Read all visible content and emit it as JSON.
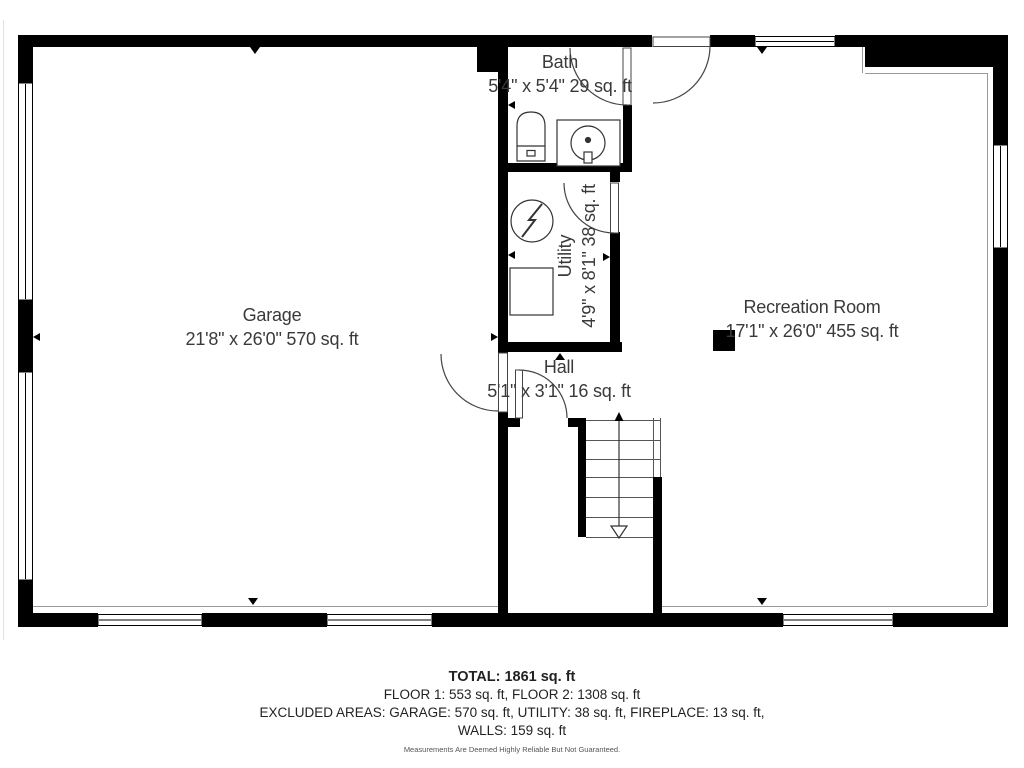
{
  "plan": {
    "rooms": {
      "garage": {
        "name": "Garage",
        "dims": "21'8\" x 26'0\" 570 sq. ft"
      },
      "bath": {
        "name": "Bath",
        "dims": "5'4\" x 5'4\" 29 sq. ft"
      },
      "utility": {
        "name": "Utility",
        "dims": "4'9\" x 8'1\" 38 sq. ft"
      },
      "hall": {
        "name": "Hall",
        "dims": "5'1\" x 3'1\" 16 sq. ft"
      },
      "recreation": {
        "name": "Recreation Room",
        "dims": "17'1\" x 26'0\" 455 sq. ft"
      }
    },
    "fixtures": [
      "toilet",
      "sink-vanity",
      "water-heater",
      "appliance",
      "fireplace",
      "staircase",
      "windows",
      "door-swings"
    ],
    "colors": {
      "wall": "#000000",
      "text": "#3a3a3a",
      "thin_line": "#999999",
      "background": "#ffffff"
    }
  },
  "footer": {
    "total": "TOTAL: 1861 sq. ft",
    "floors": "FLOOR 1: 553 sq. ft, FLOOR 2: 1308 sq. ft",
    "excluded": "EXCLUDED AREAS: GARAGE: 570 sq. ft, UTILITY: 38 sq. ft, FIREPLACE: 13 sq. ft,",
    "walls": "WALLS: 159 sq. ft",
    "disclaimer": "Measurements Are Deemed Highly Reliable But Not Guaranteed."
  }
}
